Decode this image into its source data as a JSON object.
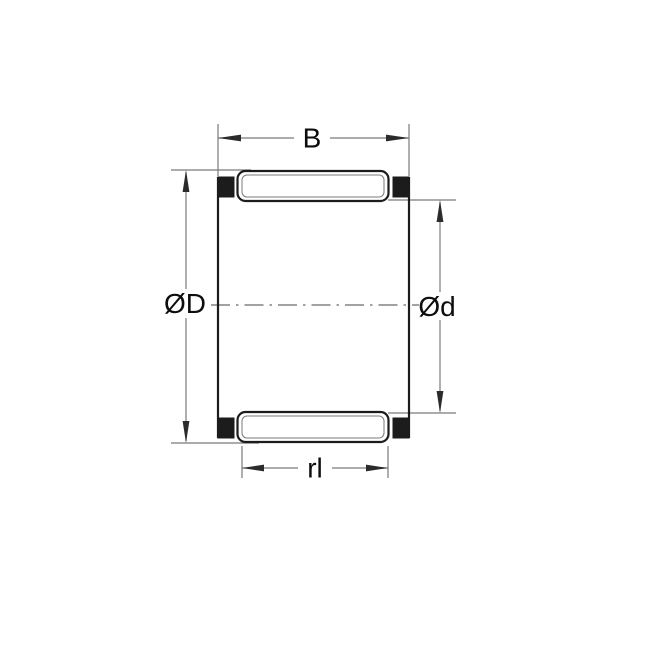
{
  "drawing": {
    "labels": {
      "width_dim": "B",
      "outer_diameter_dim": "ØD",
      "inner_diameter_dim": "Ød",
      "roller_length_dim": "rl"
    },
    "colors": {
      "line_thick": "#1c1c1c",
      "line_thin": "#7a7a7a",
      "arrow": "#2b2b2b",
      "text": "#0d0d0d",
      "fill_cage": "#1c1c1c",
      "fill_roller": "#ffffff",
      "background": "#ffffff"
    }
  }
}
